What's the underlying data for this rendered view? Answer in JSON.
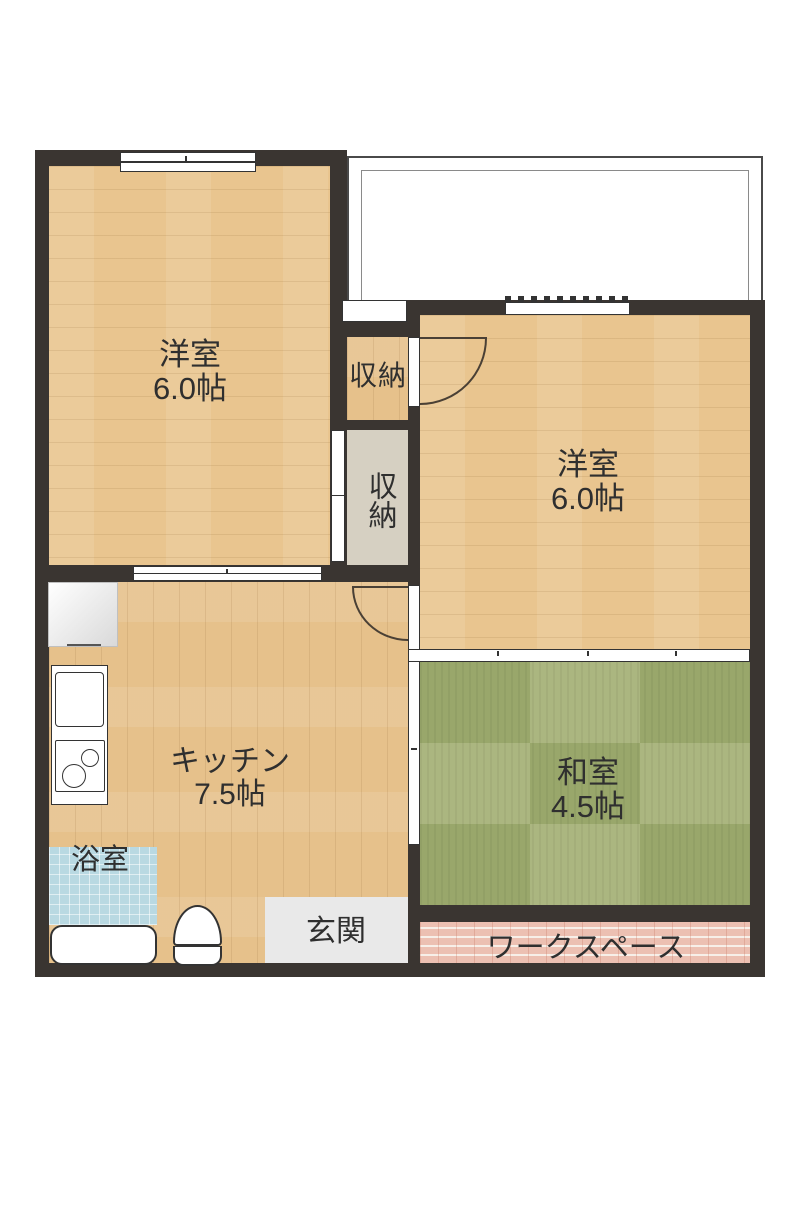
{
  "floorplan": {
    "type": "japanese-apartment-floor-plan",
    "rooms": {
      "western_room_left": {
        "label": "洋室",
        "size": "6.0帖"
      },
      "western_room_right": {
        "label": "洋室",
        "size": "6.0帖"
      },
      "kitchen": {
        "label": "キッチン",
        "size": "7.5帖"
      },
      "japanese_room": {
        "label": "和室",
        "size": "4.5帖"
      },
      "storage_top": {
        "label": "収納"
      },
      "storage_bottom": {
        "label": "収納"
      },
      "bathroom": {
        "label": "浴室"
      },
      "entrance": {
        "label": "玄関"
      },
      "workspace": {
        "label": "ワークスペース"
      }
    },
    "colors": {
      "wall": "#3a3531",
      "wood_floor": "#e9c58f",
      "tatami_light": "#abb680",
      "tatami_dark": "#99a76b",
      "storage_beige": "#d6d0c2",
      "bath_tile": "#b9d9e2",
      "entrance_gray": "#e9e9e9",
      "workspace_brick": "#ecc0b2",
      "balcony_outline": "#4a4a4a",
      "label_text": "#2f2f2f"
    }
  }
}
